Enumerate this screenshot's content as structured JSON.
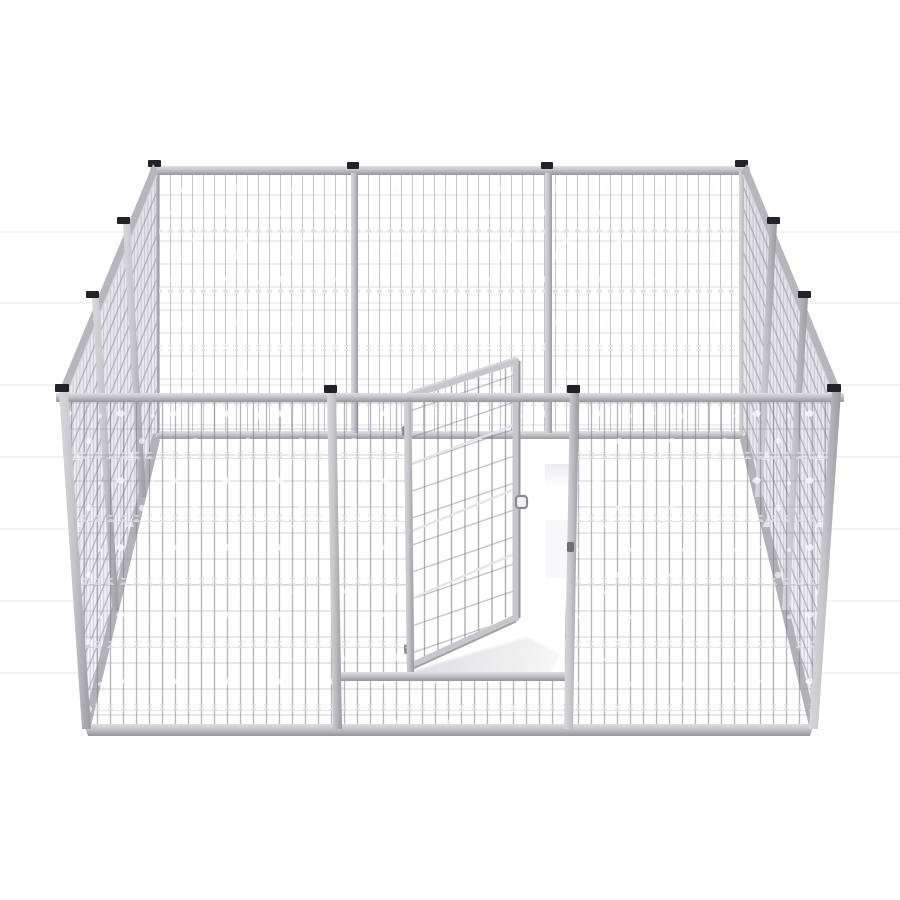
{
  "meta": {
    "domain": "Natural-Image",
    "subject": "Galvanized wire-mesh dog kennel / pet enclosure with open gate",
    "view": "three-quarter elevated front product render",
    "background": "#ffffff"
  },
  "colors": {
    "background": "#ffffff",
    "background_line": "#f3f3f6",
    "rail_light": "#dfdfe1",
    "rail_mid": "#c7c7cb",
    "rail_dark": "#97979b",
    "rail_slope": "#b7b7bb",
    "rail_slope_low": "#b3b3b7",
    "post_mid": "#c6c6ca",
    "post_cap": "#232327",
    "mesh_wire": "#8a8a96",
    "band_fill_hi": "#f4f4f7",
    "band_fill_lo": "#e6e6ea",
    "diamond_highlight": "#dcdce2",
    "floor_shadow": "#e0e0e3",
    "gate_frame": "#c7c7cb",
    "hinge": "#8f8f95",
    "latch": "#8a8a90",
    "latch_catch": "#6f6f74"
  },
  "structure": {
    "wall_count": 4,
    "panels_per_wall": 3,
    "total_panels": 12,
    "visible_post_caps": 12,
    "back_wall_posts": 4,
    "front_wall_posts": 4,
    "side_wall_intermediate_posts": 4,
    "double_wire_rows_front": 5,
    "double_wire_rows_back": 4,
    "gate": {
      "state": "open",
      "swing": "inward",
      "hinge_count": 2,
      "latch_count": 1,
      "has_threshold_rail": true,
      "has_bottom_mesh_strip": true
    }
  }
}
